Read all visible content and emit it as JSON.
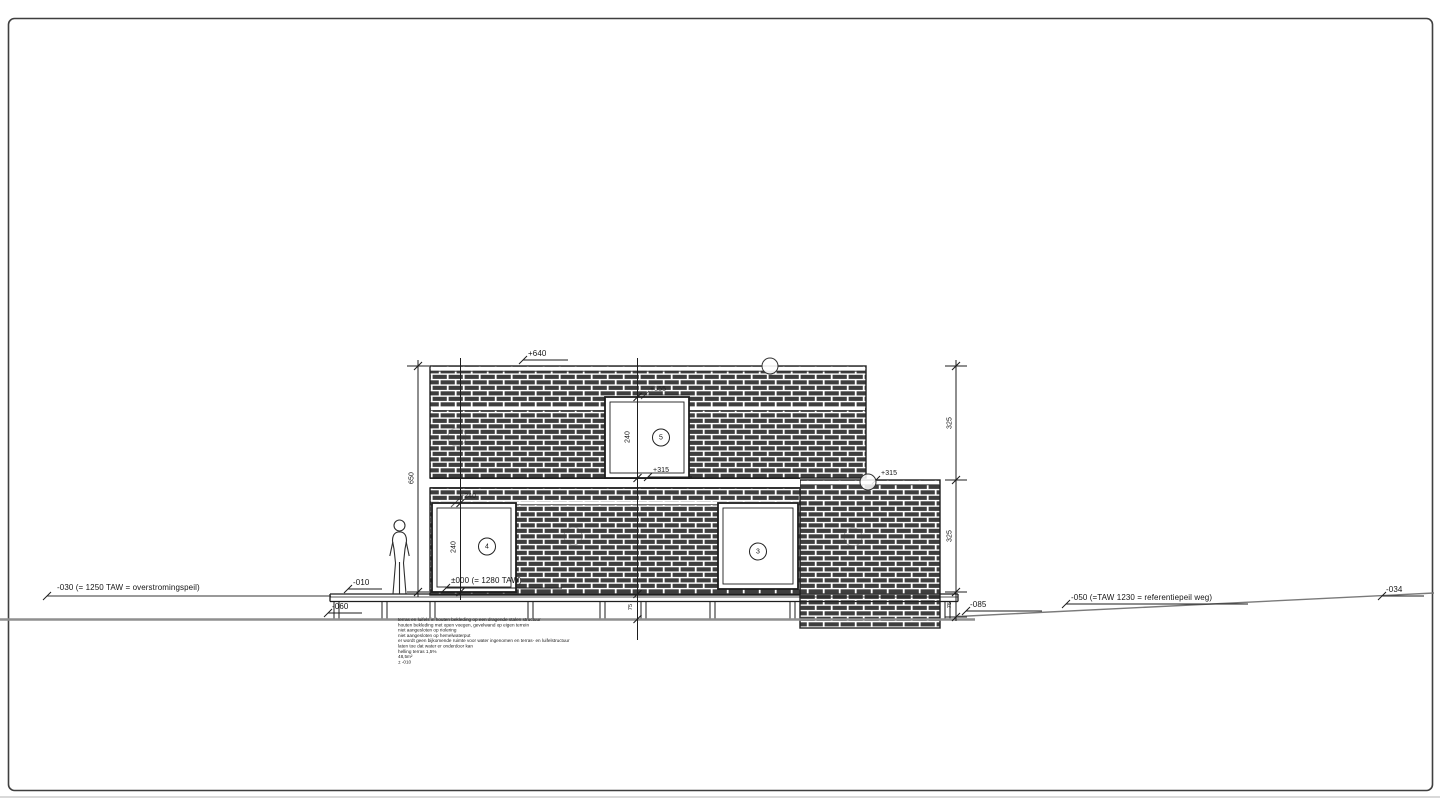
{
  "levels": {
    "top": "+640",
    "upper_window_head": "+555",
    "upper_window_sill": "+315",
    "annex_top": "+315",
    "lower_window_head": "+240",
    "zero": "±000 (= 1280 TAW)",
    "terrace": "-010",
    "terrace_under": "-060",
    "flood": "-030 (= 1250 TAW = overstromingspeil)",
    "road_ref": "-050 (=TAW 1230 = referentiepeil weg)",
    "road_far": "-034",
    "ground_right": "-085"
  },
  "dims": {
    "left_total": "650",
    "right_upper": "325",
    "right_lower": "325",
    "right_base": "75",
    "deck_base": "75",
    "window_upper_height": "240",
    "window_lower_height": "240"
  },
  "tags": {
    "window_upper": "5",
    "window_lower_left": "4",
    "window_lower_right": "3"
  },
  "notes": [
    "terras en luifels in houten bekleding op een dragende stalen structuur",
    "houten bekleding met open voegen, gevelwand op eigen terrein",
    "niet aangesloten op riolering",
    "niet aangesloten op hemelwaterput",
    "er wordt geen bijkomende ruimte voor water ingenomen en terras- en luifelstructuur",
    "laten toe dat water er onderdoor kan",
    "helling terras 1,5%",
    "48,5m²",
    "± -010"
  ],
  "colors": {
    "brick": "#3e3e3e",
    "line": "#1d1d1d",
    "ground": "#8f8f8f",
    "frame": "#3f3f3f"
  }
}
